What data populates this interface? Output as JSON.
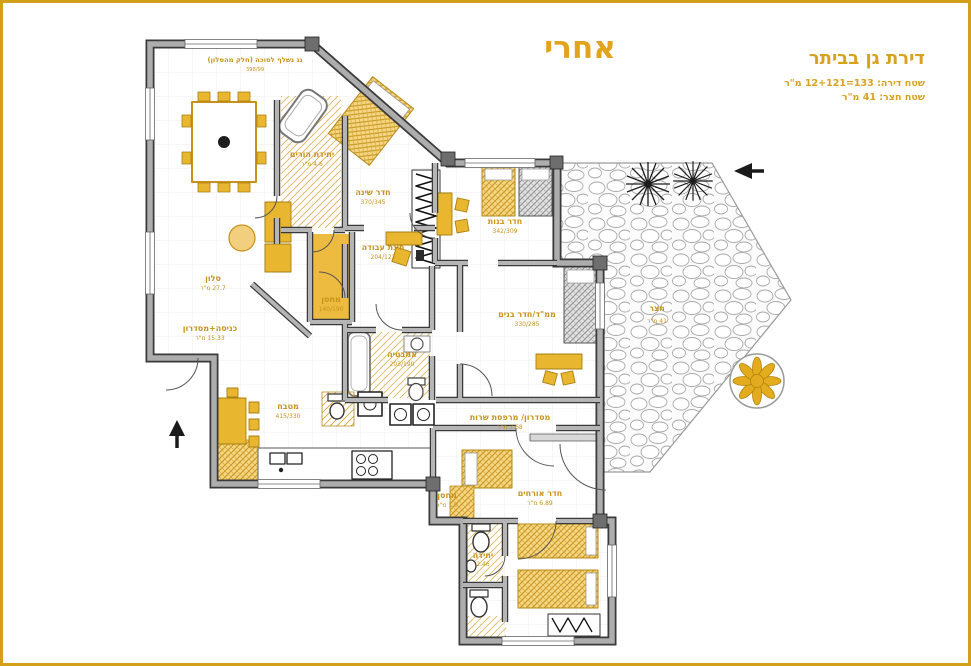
{
  "header": {
    "stage_label": "אחרי",
    "project_title": "דירת גן בביתר",
    "area_line1": "שטח דירה: 133=12+121 מ\"ר",
    "area_line2": "שטח חצר: 41 מ\"ר"
  },
  "plan": {
    "roof_note": "גג נשלף לסוכה (חלק מהסלון)",
    "roof_dims": "398/99"
  },
  "rooms": [
    {
      "name": "סלון",
      "size": "27.7 מ\"ר"
    },
    {
      "name": "יחידת הורים",
      "size": "4.6 מ\"ר"
    },
    {
      "name": "חדר שינה",
      "size": "370/345"
    },
    {
      "name": "מחסן",
      "size": "140/190"
    },
    {
      "name": "פינת עבודה",
      "size": "204/122"
    },
    {
      "name": "חדר בנות",
      "size": "342/309"
    },
    {
      "name": "ממ\"ד/חדר בנים",
      "size": "330/285"
    },
    {
      "name": "אמבטיה",
      "size": "203/190"
    },
    {
      "name": "כניסה+מסדרון",
      "size": "15.33 מ\"ר"
    },
    {
      "name": "מטבח",
      "size": "415/330"
    },
    {
      "name": "מסדרון/ מרפסת שרות",
      "size": "7.68 מ\"ר"
    },
    {
      "name": "מחסן",
      "size": "1.0 מ\"ר"
    },
    {
      "name": "חדר אורחים",
      "size": "6.89 מ\"ר"
    },
    {
      "name": "חצר",
      "size": "41 מ\"ר"
    },
    {
      "name": "יחידה",
      "size": "2.46"
    }
  ],
  "colors": {
    "accent_gold": "#E2A41F",
    "label_gold": "#C8921A",
    "wall_gray": "#ADADAD",
    "wall_dark": "#3A3A3A"
  }
}
